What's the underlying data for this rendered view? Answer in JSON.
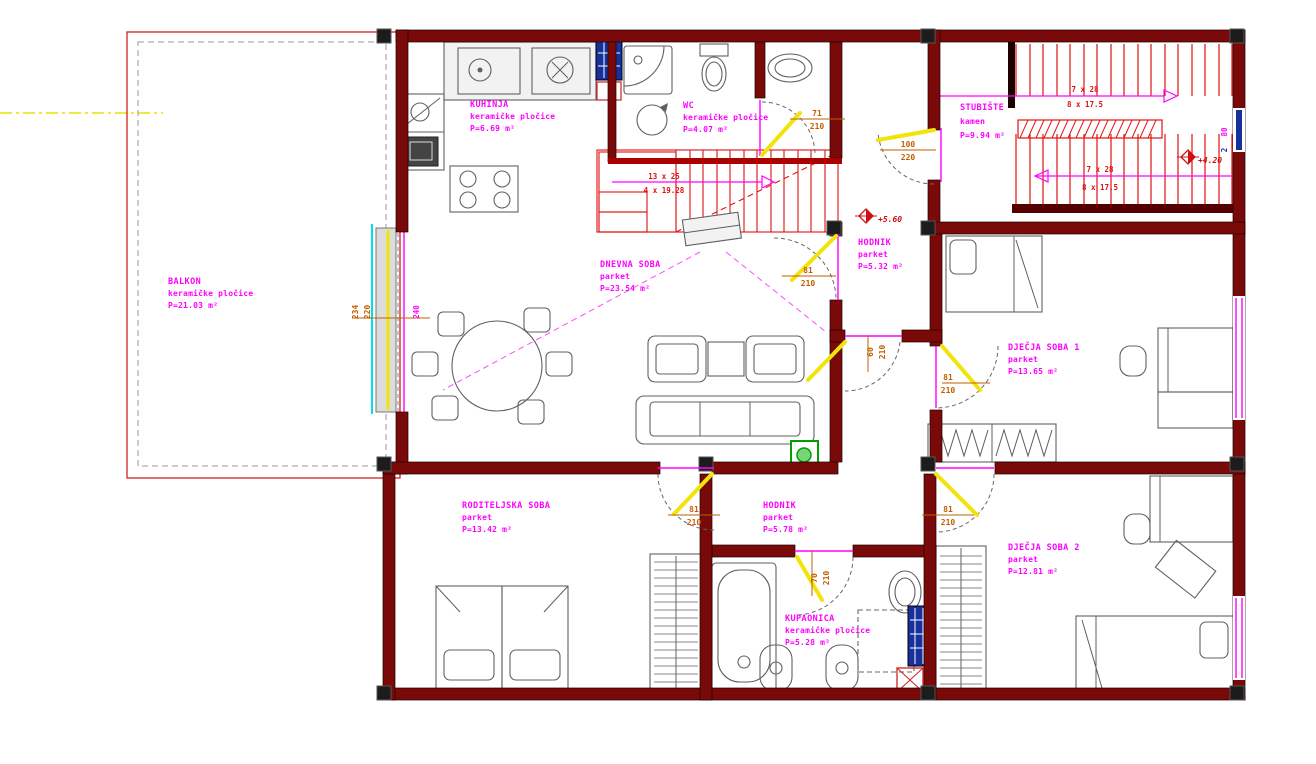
{
  "drawing": {
    "rooms": [
      {
        "name": "BALKON",
        "finish": "keramičke pločice",
        "area": "P=21.03 m²"
      },
      {
        "name": "KUHINJA",
        "finish": "keramičke pločice",
        "area": "P=6.69 m²"
      },
      {
        "name": "WC",
        "finish": "keramičke pločice",
        "area": "P=4.07 m²"
      },
      {
        "name": "STUBIŠTE",
        "finish": "kamen",
        "area": "P=9.94 m²"
      },
      {
        "name": "DNEVNA SOBA",
        "finish": "parket",
        "area": "P=23.54 m²"
      },
      {
        "name": "HODNIK",
        "finish": "parket",
        "area": "P=5.32 m²"
      },
      {
        "name": "DJEČJA SOBA 1",
        "finish": "parket",
        "area": "P=13.65 m²"
      },
      {
        "name": "RODITELJSKA SOBA",
        "finish": "parket",
        "area": "P=13.42 m²"
      },
      {
        "name": "HODNIK",
        "finish": "parket",
        "area": "P=5.78 m²"
      },
      {
        "name": "KUPAONICA",
        "finish": "keramičke pločice",
        "area": "P=5.28 m²"
      },
      {
        "name": "DJEČJA SOBA 2",
        "finish": "parket",
        "area": "P=12.81 m²"
      }
    ],
    "doors": [
      {
        "w": "71",
        "h": "210"
      },
      {
        "w": "100",
        "h": "220"
      },
      {
        "w": "81",
        "h": "210"
      },
      {
        "w": "60",
        "h": "210"
      },
      {
        "w": "81",
        "h": "210"
      },
      {
        "w": "81",
        "h": "210"
      },
      {
        "w": "81",
        "h": "210"
      },
      {
        "w": "70",
        "h": "210"
      }
    ],
    "windows": {
      "balcony_w": "234",
      "balcony_h": "220",
      "balcony_sill": "240",
      "right_w": "80",
      "right_h": "2"
    },
    "stairs": {
      "top": {
        "l1": "7 x 28",
        "l2": "8 x 17.5"
      },
      "bottom": {
        "l1": "7 x 28",
        "l2": "8 x 17.5"
      },
      "interior": {
        "l1": "13 x 25",
        "l2": "4 x 19.28"
      }
    },
    "levels": {
      "landing": "+5.60",
      "stair": "+4.20"
    }
  }
}
